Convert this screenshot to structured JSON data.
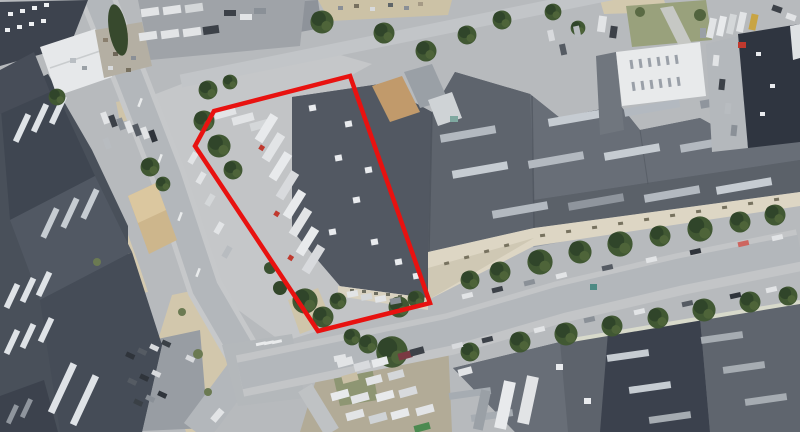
{
  "meta": {
    "view_type": "aerial-satellite-imagery",
    "description": "Oblique aerial/satellite view of an industrial district with warehouse roofs, streets, parked trucks and trees. A red polygon outlines one parcel containing a warehouse and a truck yard.",
    "width_px": 800,
    "height_px": 432
  },
  "annotation": {
    "name": "highlighted-parcel-outline",
    "points": "350,76 214,111 195,146 318,331 430,303",
    "stroke_color": "#e81210",
    "stroke_width": 4.5,
    "fill": "none"
  },
  "palette": {
    "asphalt": "#b7babd",
    "concrete_plaza": "#c6c8ca",
    "road": "#b3b7bb",
    "road_marking": "#e9ebec",
    "dirt_sand": "#d2c7ac",
    "roof_navy": "#2f3540",
    "roof_dark": "#3f4651",
    "roof_mid": "#525862",
    "roof_light": "#686e77",
    "skylight_strip": "#b3b9c0",
    "skylight_bright": "#e9ebee",
    "white_roof": "#e7e9ea",
    "cream_facade": "#ddd6c4",
    "tan_roof": "#cdb68c",
    "grass": "#99a17c",
    "tree_green": "#415833",
    "tree_green_dark": "#30452a",
    "vehicle_white": "#e2e4e6",
    "vehicle_dark": "#3c4148",
    "vehicle_red": "#c0392e"
  },
  "scene": {
    "regions": [
      {
        "name": "left-industrial-complex",
        "label": "dark warehouse roofs with skylight strips"
      },
      {
        "name": "white-roof-building",
        "label": "white flat-roof building, upper left"
      },
      {
        "name": "tan-roof-building",
        "label": "small tan roof building, mid left"
      },
      {
        "name": "parcel-warehouse",
        "label": "warehouse inside red outline with truck yard"
      },
      {
        "name": "right-warehouse-complex",
        "label": "long connected warehouse roofs with cream facade"
      },
      {
        "name": "top-right-white-building",
        "label": "white roof with vent rows"
      },
      {
        "name": "top-right-navy-building",
        "label": "dark navy roof"
      },
      {
        "name": "bottom-right-complex",
        "label": "warehouse roofs, lower right"
      },
      {
        "name": "vehicle-lot",
        "label": "yard full of vans, caravans and trailers, bottom center"
      },
      {
        "name": "street-main",
        "label": "tree-lined street running to the lower right"
      },
      {
        "name": "road-vertical",
        "label": "road descending from top toward the junction"
      },
      {
        "name": "road-upper",
        "label": "narrow road running toward the top right"
      }
    ]
  }
}
